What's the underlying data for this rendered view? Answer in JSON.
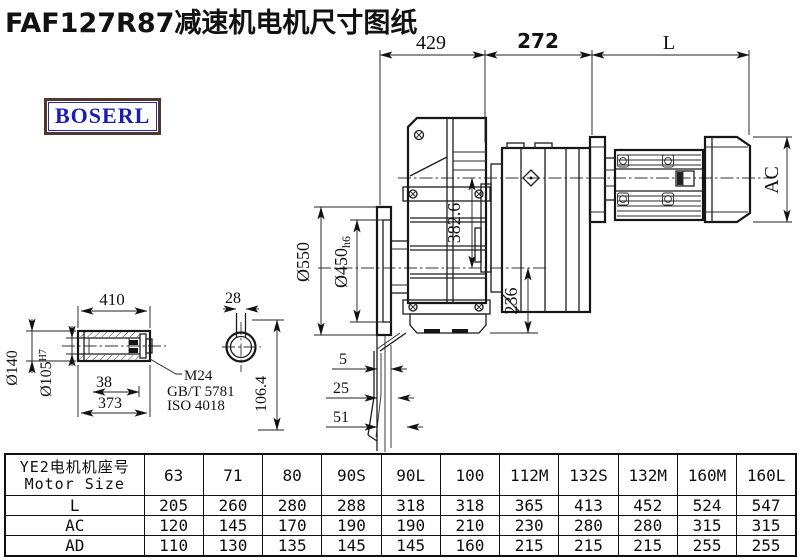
{
  "page": {
    "title": "FAF127R87减速机电机尺寸图纸",
    "brand": "BOSERL",
    "bg": "#ffffff",
    "line_color": "#1a1a1a",
    "brand_color": "#1c1cb4",
    "brand_border": "#503832"
  },
  "drawing": {
    "dims": {
      "top_left": "429",
      "top_mid": "272",
      "top_right": "L",
      "motor_dia": "AC",
      "overall_height": "382.6",
      "flange_od": "Ø550",
      "spigot_main": "Ø450",
      "spigot_tol": "h6",
      "axis_to_base": "236",
      "shaft_length": "410",
      "shaft_od": "Ø140",
      "bore_main": "Ø105",
      "bore_tol": "H7",
      "thread_depth": "38",
      "bore_depth": "373",
      "key_width": "28",
      "key_height": "106.4",
      "flange_step1": "5",
      "flange_step2": "25",
      "flange_step3": "51",
      "leader": [
        "M24",
        "GB/T 5781",
        "ISO 4018"
      ]
    }
  },
  "table": {
    "header_cn": "YE2电机机座号",
    "header_en": "Motor Size",
    "columns": [
      "63",
      "71",
      "80",
      "90S",
      "90L",
      "100",
      "112M",
      "132S",
      "132M",
      "160M",
      "160L"
    ],
    "rows": [
      {
        "label": "L",
        "values": [
          "205",
          "260",
          "280",
          "288",
          "318",
          "318",
          "365",
          "413",
          "452",
          "524",
          "547"
        ]
      },
      {
        "label": "AC",
        "values": [
          "120",
          "145",
          "170",
          "190",
          "190",
          "210",
          "230",
          "280",
          "280",
          "315",
          "315"
        ]
      },
      {
        "label": "AD",
        "values": [
          "110",
          "130",
          "135",
          "145",
          "145",
          "160",
          "215",
          "215",
          "215",
          "255",
          "255"
        ]
      }
    ]
  }
}
